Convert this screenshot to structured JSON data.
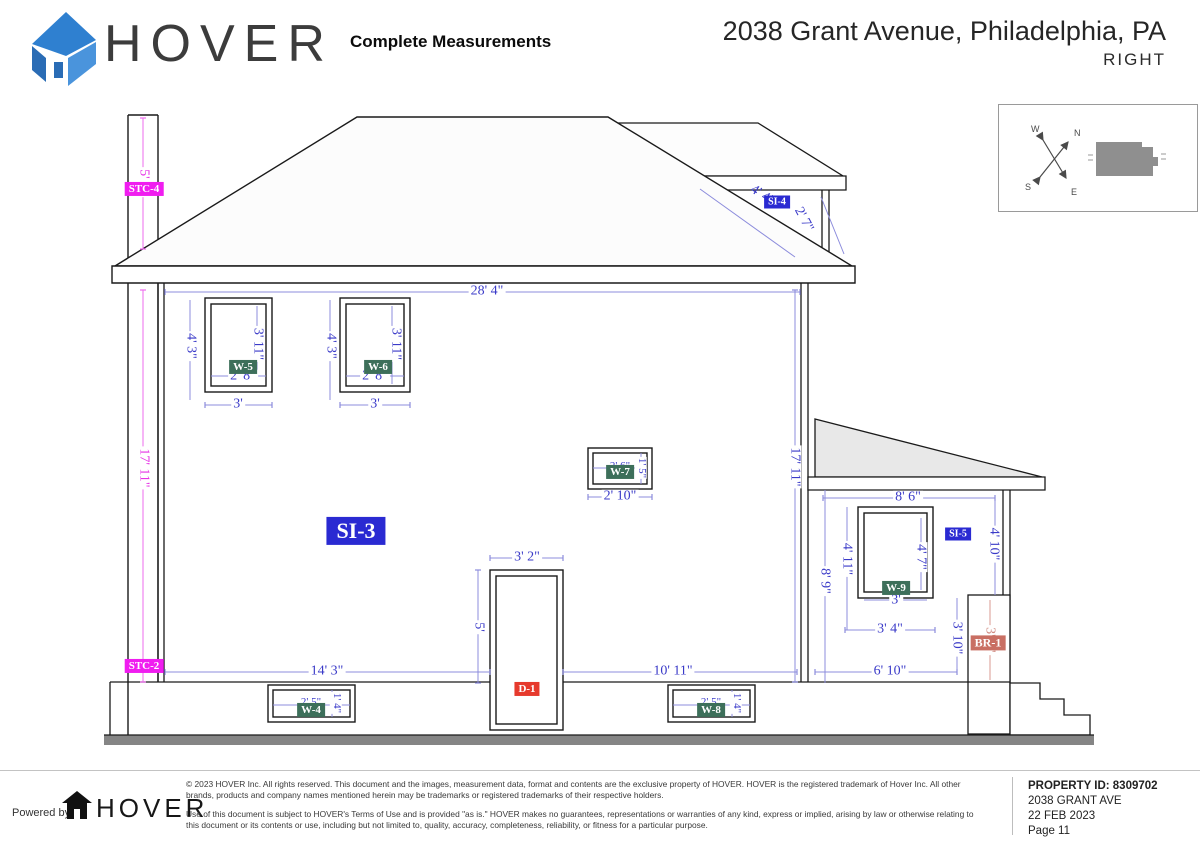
{
  "header": {
    "brand": "HOVER",
    "doc_type": "Complete Measurements",
    "address": "2038 Grant Avenue, Philadelphia, PA",
    "view": "RIGHT"
  },
  "compass": {
    "n": "N",
    "s": "S",
    "e": "E",
    "w": "W"
  },
  "colors": {
    "dim_blue": "#3a3ac8",
    "magenta": "#e632e6",
    "label_green": "#3d6f5a",
    "label_blue": "#2a2ad2",
    "label_red": "#e63a2d",
    "label_salmon": "#c96f63",
    "porch_roof_gray": "#e8e8e8",
    "ground_gray": "#858585"
  },
  "dims": [
    {
      "t": "5' 6\""
    },
    {
      "t": "17' 11\""
    },
    {
      "t": "28' 4\""
    },
    {
      "t": "4' 3\""
    },
    {
      "t": "3' 11\""
    },
    {
      "t": "2' 8\""
    },
    {
      "t": "3'"
    },
    {
      "t": "4' 3\""
    },
    {
      "t": "3' 11\""
    },
    {
      "t": "2' 8\""
    },
    {
      "t": "3'"
    },
    {
      "t": "2' 6\""
    },
    {
      "t": "1' 5\""
    },
    {
      "t": "2' 10\""
    },
    {
      "t": "3' 2\""
    },
    {
      "t": "5'"
    },
    {
      "t": "14' 3\""
    },
    {
      "t": "10' 11\""
    },
    {
      "t": "6' 10\""
    },
    {
      "t": "2' 5\""
    },
    {
      "t": "1' 4\""
    },
    {
      "t": "2' 5\""
    },
    {
      "t": "1' 4\""
    },
    {
      "t": "17' 11\""
    },
    {
      "t": "4' 4\""
    },
    {
      "t": "2' 7\""
    },
    {
      "t": "8' 6\""
    },
    {
      "t": "4' 10\""
    },
    {
      "t": "4' 11\""
    },
    {
      "t": "8' 9\""
    },
    {
      "t": "4' 7\""
    },
    {
      "t": "3'"
    },
    {
      "t": "3' 4\""
    },
    {
      "t": "3' 10\""
    },
    {
      "t": "3' 0\""
    }
  ],
  "tags": [
    {
      "t": "STC-4"
    },
    {
      "t": "STC-2"
    },
    {
      "t": "SI-3"
    },
    {
      "t": "SI-4"
    },
    {
      "t": "SI-5"
    },
    {
      "t": "W-5"
    },
    {
      "t": "W-6"
    },
    {
      "t": "W-7"
    },
    {
      "t": "W-4"
    },
    {
      "t": "W-8"
    },
    {
      "t": "W-9"
    },
    {
      "t": "D-1"
    },
    {
      "t": "BR-1"
    }
  ],
  "footer": {
    "powered_by": "Powered by",
    "brand": "HOVER",
    "line1": "© 2023 HOVER Inc. All rights reserved. This document and the images, measurement data, format and contents are the exclusive property of HOVER. HOVER is the registered trademark of Hover Inc. All other brands, products and company names mentioned herein may be trademarks or registered trademarks of their respective holders.",
    "line2": "Use of this document is subject to HOVER's Terms of Use and is provided \"as is.\" HOVER makes no guarantees, representations or warranties of any kind, express or implied, arising by law or otherwise relating to this document or its contents or use, including but not limited to, quality, accuracy, completeness, reliability, or fitness for a particular purpose.",
    "property_id": "PROPERTY ID: 8309702",
    "address": "2038 GRANT AVE",
    "date": "22 FEB 2023",
    "page": "Page 11"
  }
}
